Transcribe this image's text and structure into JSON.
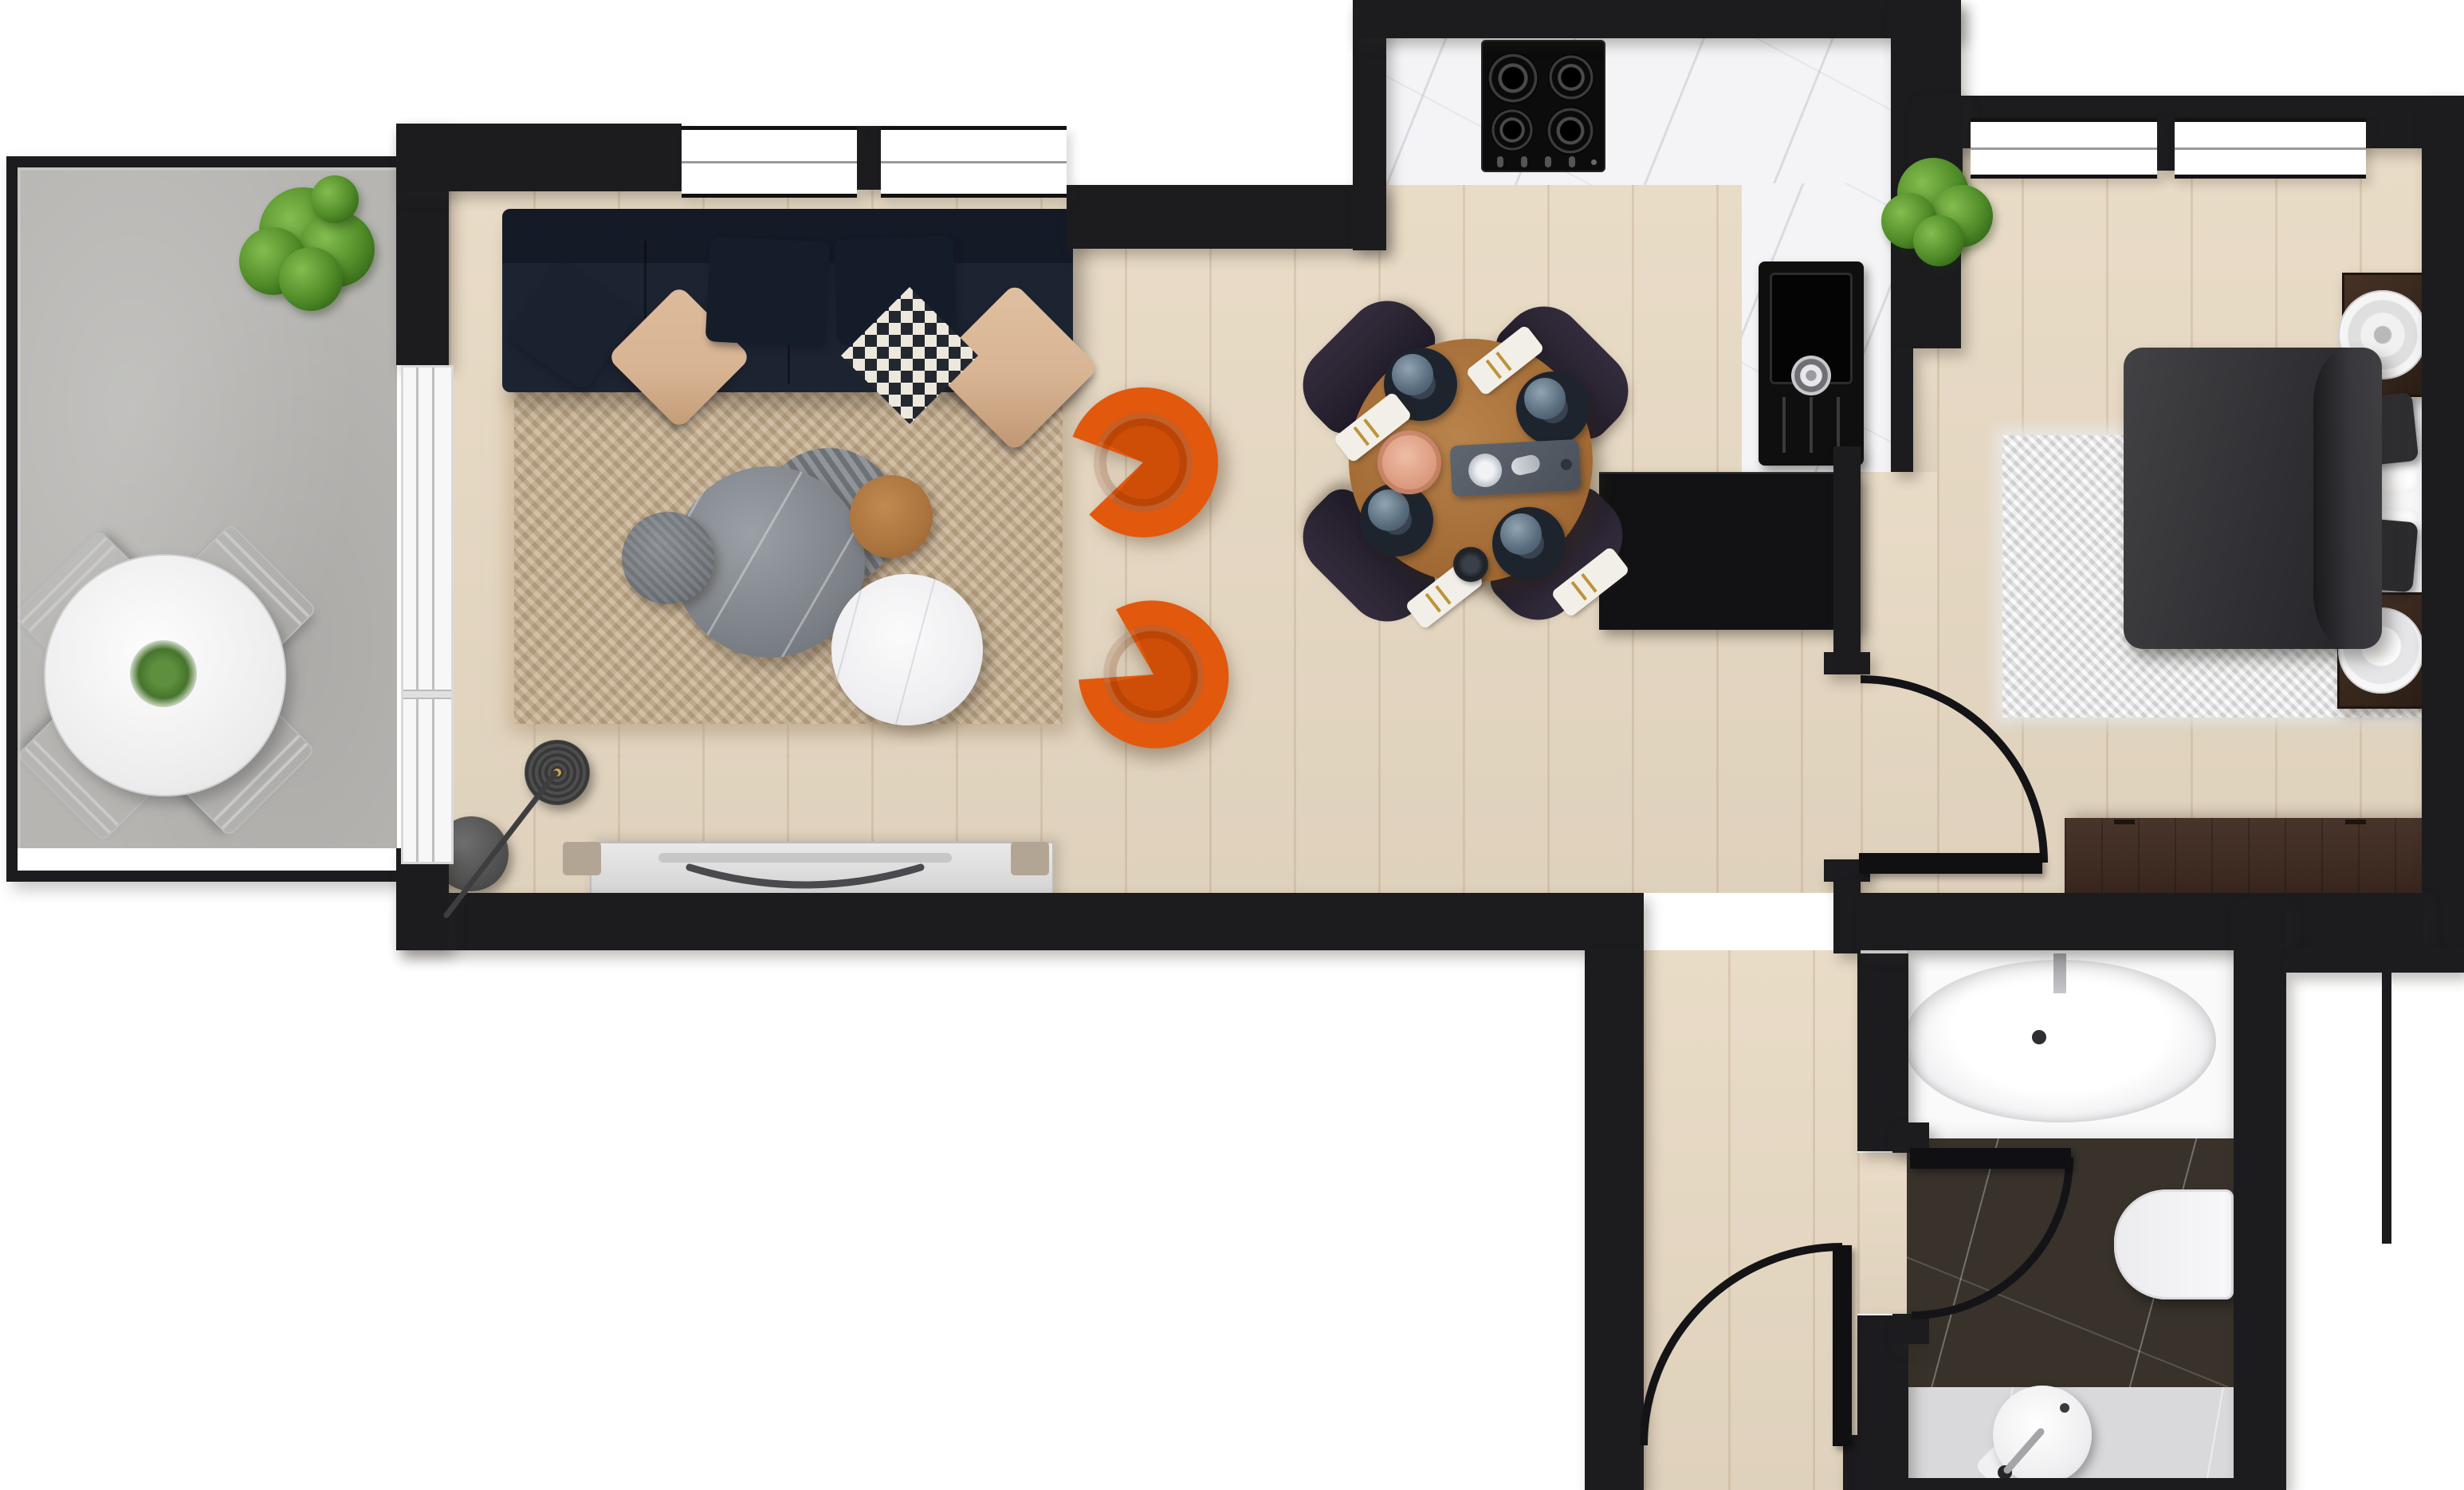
{
  "scene": {
    "kind": "residential apartment floor plan, top-down furnished render",
    "no_visible_text": true
  },
  "palette": {
    "wall": "#1c1c1f",
    "wood": "#e8dac4",
    "concrete": "#b6b5b2",
    "marble_white": "#f4f4f6",
    "marble_dark": "#38322b",
    "marble_gray": "#d9d9db",
    "rug_beige": "#c4ad8c",
    "rug_white": "#ebebeb",
    "sofa_navy": "#1d2431",
    "pillow_beige": "#d8b493",
    "accent_orange": "#e2580c",
    "dining_wood": "#a96f3a",
    "chair_dark": "#28232f",
    "duvet": "#39393d",
    "dark_wood": "#3c2b21",
    "fixture": "#fafafb",
    "plant": "#4e8a27",
    "tv_gray": "#dcdcdc"
  },
  "rooms": {
    "balcony": {
      "floor_material": "concrete",
      "items": [
        "round-outdoor-dining-table",
        "outdoor-chair x4",
        "table-centerpiece-plant",
        "potted-shrub",
        "sliding-glass-door"
      ]
    },
    "living_room": {
      "floor_material": "light-oak-plank",
      "items": [
        "navy-fabric-sofa",
        "throw-pillow x6",
        "beige-shag-rug",
        "gray-marble-coffee-table",
        "striped-accent-table",
        "oak-side-table",
        "small-gray-side-table",
        "white-marble-coffee-table",
        "orange-tub-armchair x2",
        "arc-floor-lamp",
        "media-console",
        "tv-with-curved-stand",
        "window x2"
      ]
    },
    "dining_area": {
      "items": [
        "round-walnut-dining-table",
        "black-dining-chair x4",
        "place-setting x4",
        "serving-board",
        "copper-tray",
        "coffee-cup"
      ]
    },
    "kitchen": {
      "floor_material": "white-marble",
      "items": [
        "marble-counter-run",
        "gas-cooktop-4-burner",
        "control-knobs x4",
        "black-composite-sink",
        "sink-faucet",
        "drainboard-grooves",
        "black-base-cabinet"
      ]
    },
    "bedroom": {
      "floor_material": "light-oak-plank",
      "items": [
        "double-bed",
        "charcoal-duvet",
        "white-pillow x2",
        "dark-accent-pillow x2",
        "white-shag-rug",
        "nightstand-with-round-tray x2",
        "dark-walnut-dresser",
        "potted-plant",
        "window x2",
        "interior-door-with-swing-arc"
      ]
    },
    "bathroom": {
      "floor_material": "dark-marble and gray-marble",
      "items": [
        "oval-bathtub",
        "tub-faucet",
        "wall-hung-toilet",
        "round-basin-sink",
        "chrome-faucet",
        "interior-door-with-swing-arc"
      ]
    },
    "hallway": {
      "items": [
        "entry-door-with-swing-arc"
      ]
    }
  }
}
